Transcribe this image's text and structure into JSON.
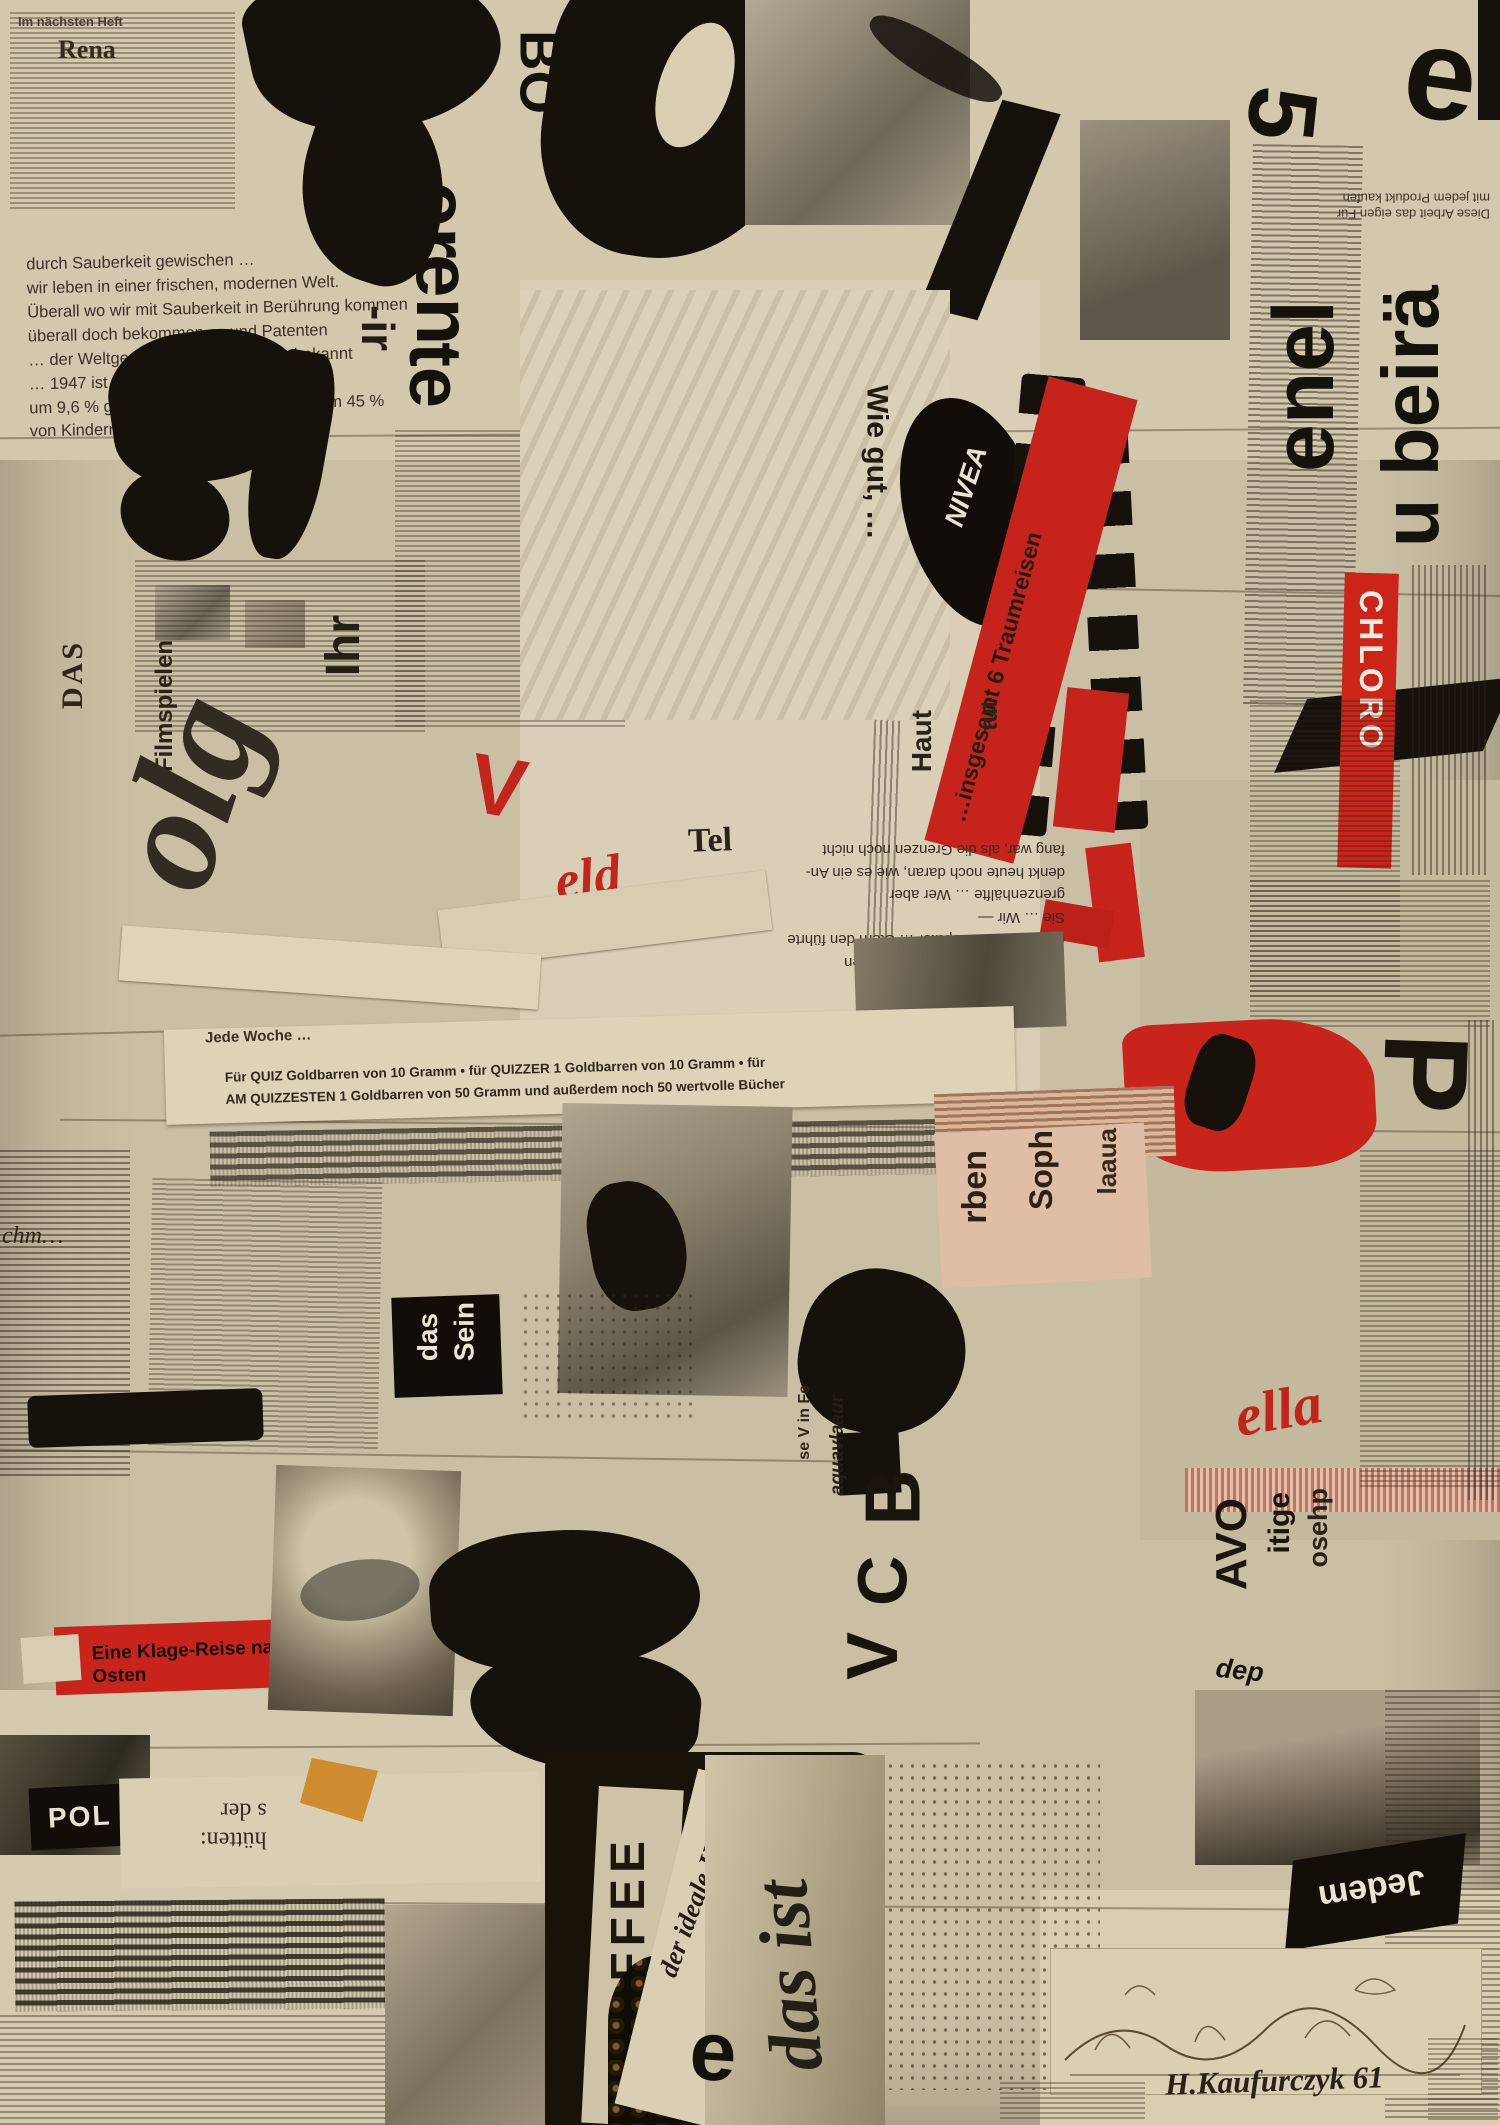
{
  "artwork": {
    "medium_note": "newspaper collage",
    "signature": "H.Kaufurczyk 61"
  },
  "palette": {
    "paper": "#c9bfa4",
    "paper_light": "#dcd3bb",
    "ink": "#17110c",
    "red": "#c2221a",
    "salmon": "#dfbda6",
    "orange": "#cf8c2e"
  },
  "texts": {
    "next_issue": "Im nächsten Heft",
    "rena": "Rena",
    "sauberkeit": "durch Sauberkeit gewischen …\nwir leben in einer frischen, modernen Welt.\nÜberall wo wir mit Sauberkeit in Berührung kommen\nüberall doch bekommen … und Patenten\n… der Weltgesundheitsorganisation bekannt\n… 1947 ist die Sterblichkeit allgemein\num 9,6 % gesunken … von Säuglingen um 45 %\nvon Kindern sogar um 57 %.",
    "letter_bo": "BO",
    "letter_er": "er",
    "letter_en": "en",
    "letter_te": "te",
    "letter_ir": "-ir",
    "letter_e": "e",
    "letter_5": "5",
    "letter_p": "P",
    "letter_e2": "e",
    "enel": "enel",
    "u_beira": "u beirä",
    "diese_arbeit": "Diese Arbeit das eigen Für\nmit jedem Produkt kaufen",
    "chloro": "CHLORO",
    "nivea": "NIVEA",
    "wie_gut": "Wie gut, …",
    "traumreisen": "…insgesamt 6 Traumreisen",
    "haut": "Haut",
    "tut": "tut",
    "tel": "Tel",
    "irrfahrt_block": "… dramatischen Irrfahrt über den\ndeutsch- Jude.  Später … Stern den führte\nSie …  Wir —\ngrenzenhälfte …  Wer aber\ndenkt heute noch daran, wie es ein An-\nfang war, als die Grenzen noch nicht",
    "das_label": "DAS",
    "filmspielen": "Filmspielen",
    "ihr": "Ihr",
    "olg": "olg",
    "v_mark": "V",
    "eld": "eld",
    "jede_woche": "Jede Woche …",
    "quiz": "Für QUIZ Goldbarren von 10 Gramm • für QUIZZER 1 Goldbarren von 10 Gramm • für\nAM QUIZZESTEN 1 Goldbarren von 50 Gramm und außerdem noch 50 wertvolle Bücher",
    "rben": "rben",
    "soph": "Soph",
    "laaua": "laaua",
    "das_sein": "das\nSein",
    "klage": "Eine Klage-Reise nach Osten",
    "chm": "chm…",
    "vob_b": "B",
    "vob_c": "C",
    "vob_v": "V",
    "se_v": "se V  in Fe",
    "aqua": "aquavlaaur",
    "avo": "AVO",
    "itige": "itige",
    "osehp": "osehp",
    "ella": "ella",
    "dep": "dep\nden\nAM",
    "jedem": "Jedem",
    "pol": "POL",
    "huetten": "hütten:\ns der",
    "kaffee": "KAFFEE",
    "ideale": "der ideale Kaffee\nder Zeit",
    "das_ist": "das ist",
    "signature": "H.Kaufurczyk 61"
  }
}
